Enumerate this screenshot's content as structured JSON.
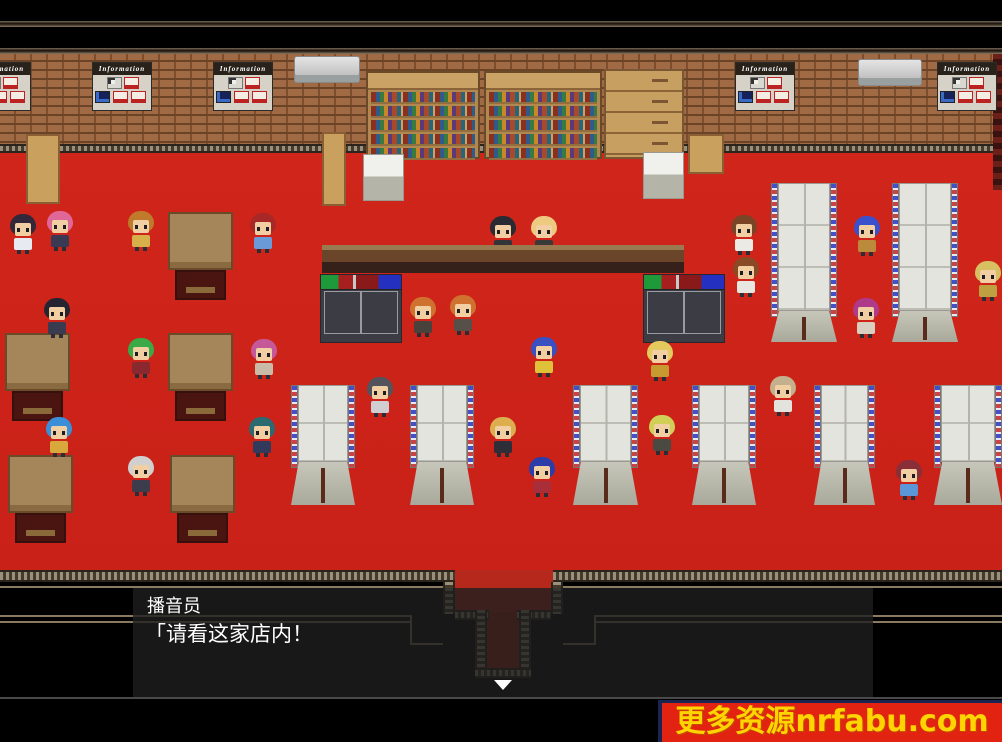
{
  "meta": {
    "app": "rpg-game-screenshot",
    "scene": "store-interior",
    "width": 1002,
    "height": 742
  },
  "dialog": {
    "speaker": "播音员",
    "message": "「请看这家店内！",
    "continue_indicator": "▼"
  },
  "watermark": {
    "text": "更多资源nrfabu.com",
    "bg": "#e32312",
    "fg": "#ffd400"
  },
  "scene": {
    "colors": {
      "carpet": "#cc2318",
      "wall_brick": "#a06a44",
      "counter": "#6a452a",
      "letterbox": "#000000",
      "dialog_bg": "rgba(30,30,30,0.8)"
    },
    "posters": {
      "label": "Information",
      "positions": [
        [
          -29,
          62
        ],
        [
          92,
          62
        ],
        [
          213,
          62
        ],
        [
          735,
          62
        ],
        [
          937,
          62
        ]
      ]
    },
    "air_conditioners": [
      [
        294,
        56,
        64
      ],
      [
        858,
        59,
        62
      ]
    ],
    "bookshelves": [
      [
        366,
        71,
        114
      ],
      [
        484,
        71,
        118
      ]
    ],
    "cabinet": [
      604,
      69,
      80,
      90
    ],
    "pillars": [
      [
        363,
        154
      ],
      [
        643,
        152
      ]
    ],
    "wood_pieces": [
      [
        26,
        134,
        34,
        70
      ],
      [
        322,
        132,
        24,
        74
      ],
      [
        688,
        134,
        36,
        40
      ]
    ],
    "tables": [
      [
        168,
        212
      ],
      [
        5,
        333
      ],
      [
        168,
        333
      ],
      [
        8,
        455
      ],
      [
        170,
        455
      ]
    ],
    "racks": [
      [
        320,
        274
      ],
      [
        643,
        274
      ]
    ],
    "stands_small": [
      [
        291,
        385,
        64
      ],
      [
        410,
        385,
        64
      ],
      [
        573,
        385,
        65
      ],
      [
        692,
        385,
        64
      ],
      [
        814,
        385,
        61
      ],
      [
        934,
        385,
        68
      ]
    ],
    "stands_tall": [
      [
        771,
        183,
        66
      ],
      [
        892,
        183,
        66
      ]
    ],
    "npcs": [
      {
        "id": "schoolgirl",
        "x": 8,
        "y": 214,
        "hair": "#33283a",
        "outfit": "#e8eaf2"
      },
      {
        "id": "pink-girl",
        "x": 45,
        "y": 211,
        "hair": "#e06898",
        "outfit": "#3a3a55"
      },
      {
        "id": "orange-boy",
        "x": 126,
        "y": 211,
        "hair": "#c07a2c",
        "outfit": "#d8b04a"
      },
      {
        "id": "red-spiky-boy",
        "x": 248,
        "y": 213,
        "hair": "#a82828",
        "outfit": "#6a9ad8"
      },
      {
        "id": "dark-suit-man",
        "x": 42,
        "y": 298,
        "hair": "#262430",
        "outfit": "#3a3a50"
      },
      {
        "id": "green-spiky-man",
        "x": 126,
        "y": 338,
        "hair": "#3aaa46",
        "outfit": "#8a2830"
      },
      {
        "id": "magenta-girl",
        "x": 249,
        "y": 339,
        "hair": "#c45898",
        "outfit": "#cabba8"
      },
      {
        "id": "teal-man",
        "x": 247,
        "y": 417,
        "hair": "#2a6a70",
        "outfit": "#323a5c"
      },
      {
        "id": "jellyfish-hat-man",
        "x": 44,
        "y": 417,
        "hair": "#3a8fd8",
        "outfit": "#d8a83c"
      },
      {
        "id": "turban-man",
        "x": 126,
        "y": 456,
        "hair": "#d0d0d0",
        "outfit": "#3c3c4c"
      },
      {
        "id": "clerk-black-hair",
        "x": 488,
        "y": 216,
        "hair": "#2a2a33",
        "outfit": "#33333a",
        "z": 4
      },
      {
        "id": "clerk-bald",
        "x": 529,
        "y": 216,
        "hair": "#eec980",
        "outfit": "#3a3a3a",
        "z": 4
      },
      {
        "id": "orange-man-1",
        "x": 408,
        "y": 297,
        "hair": "#d0722f",
        "outfit": "#49413c"
      },
      {
        "id": "orange-man-2",
        "x": 448,
        "y": 295,
        "hair": "#d0722f",
        "outfit": "#565049"
      },
      {
        "id": "blue-hair-yellow-shirt",
        "x": 529,
        "y": 337,
        "hair": "#3a50c0",
        "outfit": "#e0c23a"
      },
      {
        "id": "gray-hair-man",
        "x": 365,
        "y": 377,
        "hair": "#53535c",
        "outfit": "#cfcfd2"
      },
      {
        "id": "blonde-woman-black",
        "x": 488,
        "y": 417,
        "hair": "#ddae4e",
        "outfit": "#2e2e38"
      },
      {
        "id": "blue-ponytail-girl",
        "x": 527,
        "y": 457,
        "hair": "#2c3daa",
        "outfit": "#aa2e3a"
      },
      {
        "id": "brown-hair-woman",
        "x": 729,
        "y": 215,
        "hair": "#7a4526",
        "outfit": "#eceae4"
      },
      {
        "id": "brown-hair-man",
        "x": 731,
        "y": 257,
        "hair": "#8a4a26",
        "outfit": "#e8e6e0"
      },
      {
        "id": "blue-hair-boy",
        "x": 852,
        "y": 216,
        "hair": "#3a50cc",
        "outfit": "#bb8a3a"
      },
      {
        "id": "beret-girl",
        "x": 851,
        "y": 298,
        "hair": "#b03a8a",
        "outfit": "#d8cfc0"
      },
      {
        "id": "blonde-bob-woman",
        "x": 973,
        "y": 261,
        "hair": "#d8c062",
        "outfit": "#bfa040"
      },
      {
        "id": "big-blonde-woman",
        "x": 645,
        "y": 341,
        "hair": "#e3c95e",
        "outfit": "#c89a32"
      },
      {
        "id": "yellowgreen-girl",
        "x": 647,
        "y": 415,
        "hair": "#cfd055",
        "outfit": "#4a4a42"
      },
      {
        "id": "tan-hair-man",
        "x": 768,
        "y": 376,
        "hair": "#c4b08c",
        "outfit": "#e4e2dc"
      },
      {
        "id": "maroon-hair-man",
        "x": 894,
        "y": 460,
        "hair": "#8a2f38",
        "outfit": "#5b96d8"
      }
    ]
  }
}
